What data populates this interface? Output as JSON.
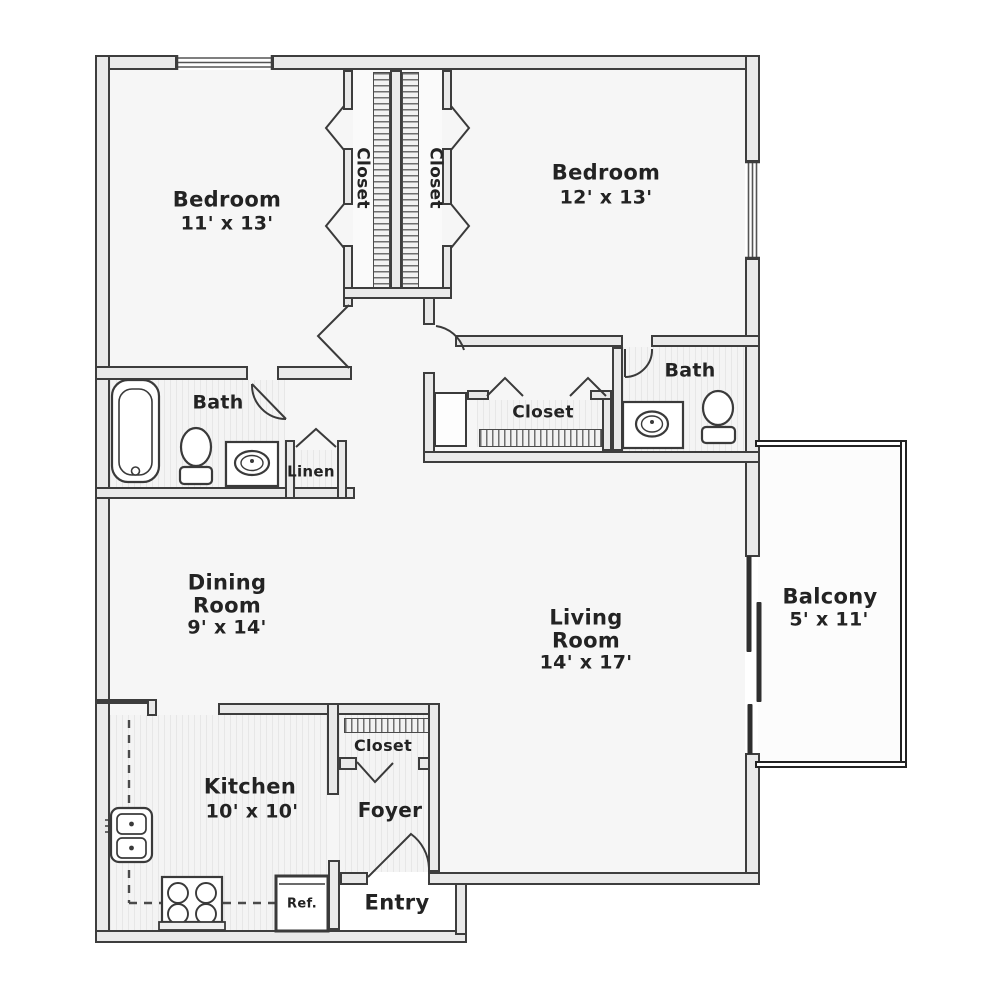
{
  "floor_plan": {
    "title": "Two bedroom apartment floor plan",
    "rooms": {
      "bedroom1": {
        "name": "Bedroom",
        "dims": "11' x 13'"
      },
      "bedroom2": {
        "name": "Bedroom",
        "dims": "12' x 13'"
      },
      "closet_left": {
        "name": "Closet"
      },
      "closet_right": {
        "name": "Closet"
      },
      "bath_left": {
        "name": "Bath"
      },
      "bath_right": {
        "name": "Bath"
      },
      "linen": {
        "name": "Linen"
      },
      "closet_hall": {
        "name": "Closet"
      },
      "dining": {
        "line1": "Dining",
        "line2": "Room",
        "dims": "9' x 14'"
      },
      "living": {
        "line1": "Living",
        "line2": "Room",
        "dims": "14' x 17'"
      },
      "balcony": {
        "name": "Balcony",
        "dims": "5' x 11'"
      },
      "kitchen": {
        "name": "Kitchen",
        "dims": "10' x 10'"
      },
      "closet_foyer": {
        "name": "Closet"
      },
      "foyer": {
        "name": "Foyer"
      },
      "entry": {
        "name": "Entry"
      },
      "refrigerator": {
        "label": "Ref."
      }
    },
    "colors": {
      "wall_outline": "#3d3d3d",
      "wall_fill": "#e9e9e9",
      "balcony_wall": "#222222",
      "text": "#232323",
      "floor": "#f6f6f6"
    }
  }
}
